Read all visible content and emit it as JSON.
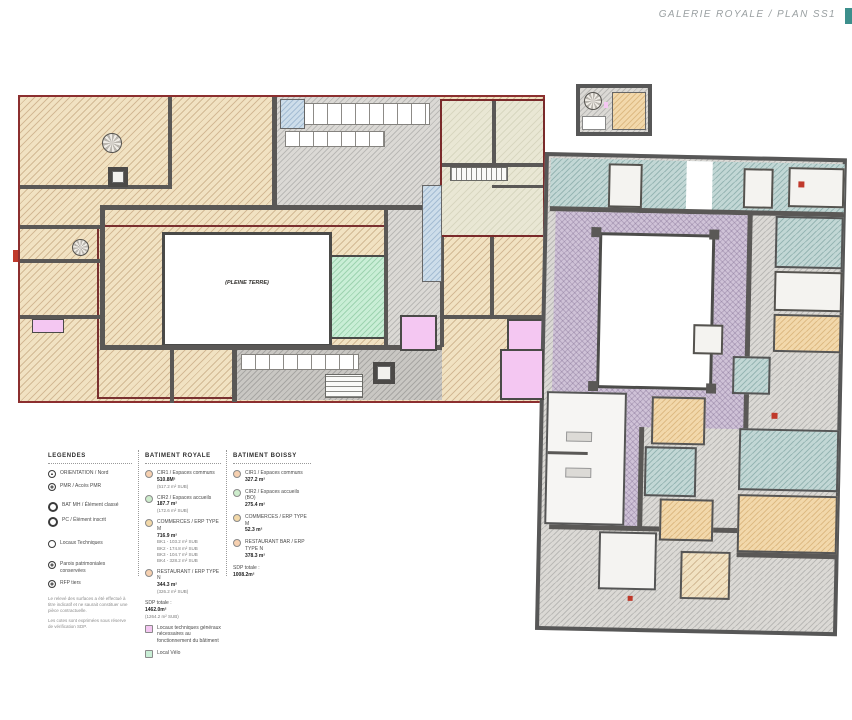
{
  "header": {
    "title": "GALERIE ROYALE / PLAN SS1"
  },
  "plan_left": {
    "courtyard_label": "(PLEINE TERRE)"
  },
  "colors": {
    "wall": "#5a5856",
    "plan_outline_red": "#8c2f2f",
    "beige": "#f1e2c2",
    "purple": "#cfc2d7",
    "teal": "#c2d7d5",
    "green": "#c9eed6",
    "pink": "#f4c7f2",
    "orange": "#f2d8ab",
    "blue": "#cdddea",
    "gray": "#dbd9d5",
    "olive": "#e9e7d4",
    "accent_teal_marker": "#3c8f8c"
  },
  "legend": {
    "col1": {
      "title": "LEGENDES",
      "items": [
        {
          "icon": "north-arrow-icon",
          "label": "ORIENTATION / Nord"
        },
        {
          "icon": "pmr-icon",
          "label": "PMR / Accès PMR"
        },
        {
          "icon": "mh-circle-icon",
          "label": "BAT MH / Élément classé"
        },
        {
          "icon": "pc-circle-icon",
          "label": "PC / Élément inscrit"
        },
        {
          "icon": "circle-icon",
          "label": "Locaux Techniques"
        },
        {
          "icon": "target-icon",
          "label": "Parois patrimoniales conservées"
        },
        {
          "icon": "target-icon",
          "label": "RFP tiers"
        }
      ],
      "footnote1": "Le relevé des surfaces a été effectué à titre indicatif et ne saurait constituer une pièce contractuelle.",
      "footnote2": "Les cotes sont exprimées sous réserve de vérification SDP."
    },
    "col2": {
      "title": "BATIMENT ROYALE",
      "items": [
        {
          "swatch": "#f6d0b0",
          "label": "CIR1 / Espaces communs",
          "value": "510.8M²",
          "sub": "(517.2 m² SUB)"
        },
        {
          "swatch": "#cdeccc",
          "label": "CIR2 / Espaces accueils",
          "value": "187.7 m²",
          "sub": "(172.6 m² SUB)"
        },
        {
          "swatch": "#f2d8a8",
          "label": "COMMERCES / ERP TYPE M",
          "value": "716.9 m²",
          "sub": "BK1 - 103.2 m² SUB\nBK2 - 174.8 m² SUB\nBK3 - 104.7 m² SUB\nBK4 - 328.2 m² SUB"
        },
        {
          "swatch": "#f6d0b0",
          "label": "RESTAURANT / ERP TYPE N",
          "value": "344.3 m²",
          "sub": "(326.2 m² SUB)"
        }
      ],
      "total_label": "SDP totale :",
      "total_value": "1462.0m²",
      "total_sub": "(1264.2 m² SUB)",
      "extras": [
        {
          "swatch": "#f4c7f2",
          "label": "Locaux techniques généraux nécessaires au fonctionnement du bâtiment"
        },
        {
          "swatch": "#c9eed6",
          "label": "Local Vélo"
        }
      ]
    },
    "col3": {
      "title": "BATIMENT BOISSY",
      "items": [
        {
          "swatch": "#f6d0b0",
          "label": "CIR1 / Espaces communs",
          "value": "327.2 m²"
        },
        {
          "swatch": "#cdeccc",
          "label": "CIR2 / Espaces accueils (BO)",
          "value": "275.4 m²"
        },
        {
          "swatch": "#f2d8a8",
          "label": "COMMERCES / ERP TYPE M",
          "value": "52.3 m²"
        },
        {
          "swatch": "#f6d0b0",
          "label": "RESTAURANT BAR / ERP TYPE N",
          "value": "378.3 m²"
        }
      ],
      "total_label": "SDP totale :",
      "total_value": "1008.2m²"
    }
  }
}
